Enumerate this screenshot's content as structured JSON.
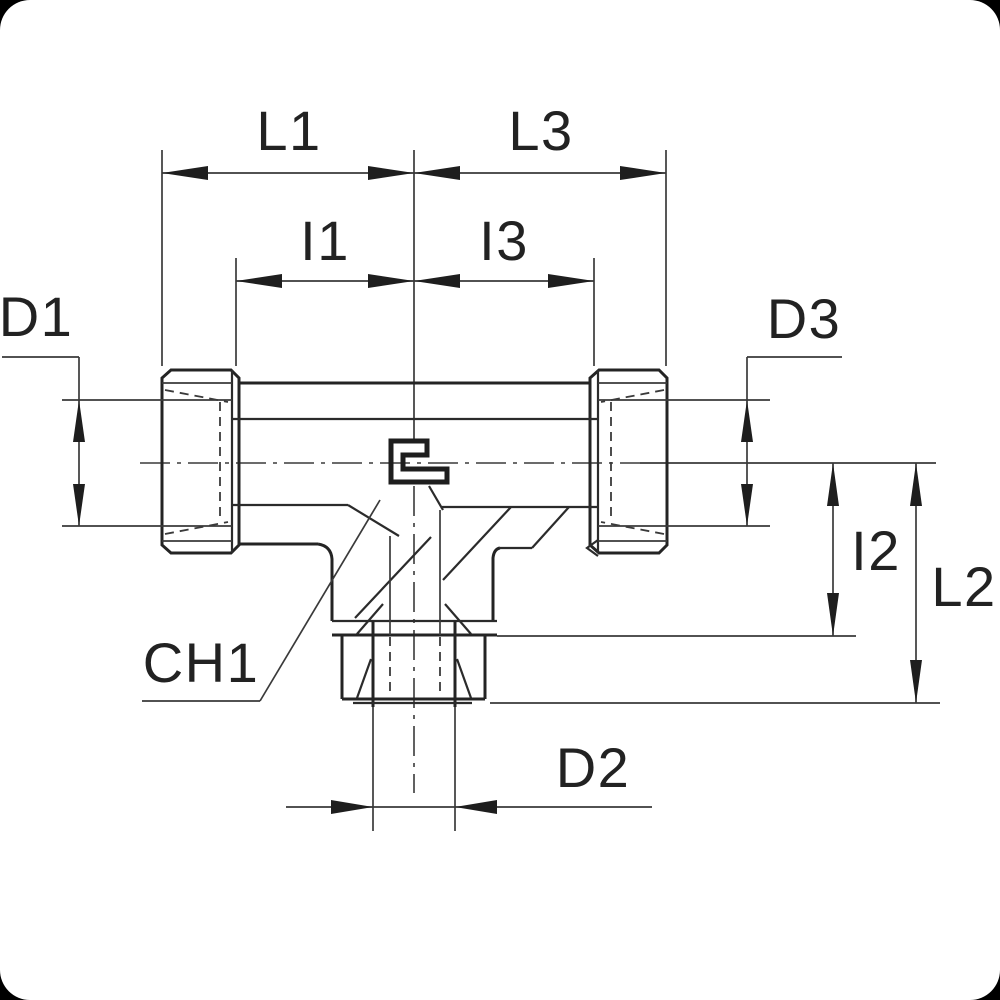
{
  "drawing": {
    "title": "tee-fitting-dimension-drawing",
    "colors": {
      "canvas": "#000000",
      "paper": "#ffffff",
      "line": "#2b2b2b",
      "label": "#222222"
    },
    "labels": {
      "l1": "L1",
      "l3": "L3",
      "i1": "I1",
      "i3": "I3",
      "d1": "D1",
      "d3": "D3",
      "i2": "I2",
      "l2": "L2",
      "ch1": "CH1",
      "d2": "D2"
    }
  }
}
